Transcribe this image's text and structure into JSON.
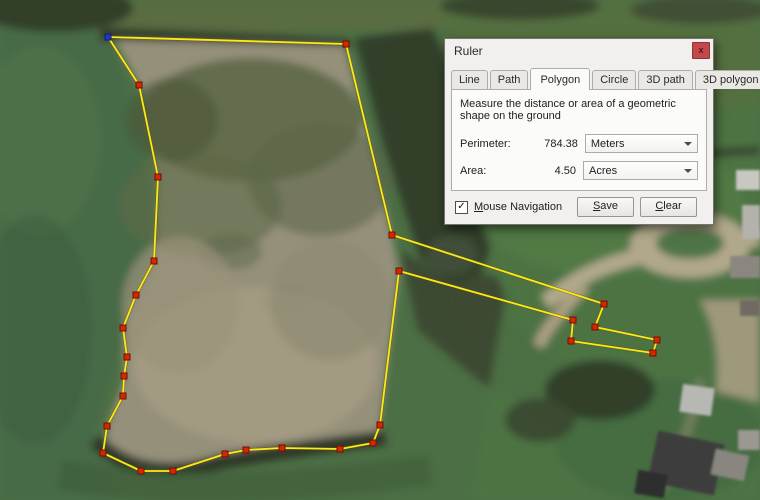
{
  "dialog": {
    "title": "Ruler",
    "close_label": "x",
    "tabs": [
      {
        "label": "Line"
      },
      {
        "label": "Path"
      },
      {
        "label": "Polygon",
        "active": true
      },
      {
        "label": "Circle"
      },
      {
        "label": "3D path"
      },
      {
        "label": "3D polygon"
      }
    ],
    "description": "Measure the distance or area of a geometric shape on the ground",
    "perimeter": {
      "label": "Perimeter:",
      "value": "784.38",
      "unit": "Meters"
    },
    "area": {
      "label": "Area:",
      "value": "4.50",
      "unit": "Acres"
    },
    "mouse_navigation": {
      "checked": true,
      "checkmark": "✓",
      "key": "M",
      "rest": "ouse Navigation"
    },
    "save_button": {
      "key": "S",
      "rest": "ave"
    },
    "clear_button": {
      "key": "C",
      "rest": "lear"
    }
  },
  "map": {
    "polygon": {
      "stroke_color": "#ffe81a",
      "vertex_color": "#d82700",
      "start_vertex_color": "#2433c8",
      "vertices": [
        [
          108,
          37
        ],
        [
          346,
          44
        ],
        [
          392,
          235
        ],
        [
          604,
          304
        ],
        [
          595,
          327
        ],
        [
          657,
          340
        ],
        [
          653,
          353
        ],
        [
          571,
          341
        ],
        [
          573,
          320
        ],
        [
          399,
          271
        ],
        [
          380,
          425
        ],
        [
          373,
          443
        ],
        [
          340,
          449
        ],
        [
          282,
          448
        ],
        [
          246,
          450
        ],
        [
          225,
          454
        ],
        [
          173,
          471
        ],
        [
          141,
          471
        ],
        [
          103,
          453
        ],
        [
          107,
          426
        ],
        [
          123,
          396
        ],
        [
          124,
          376
        ],
        [
          127,
          357
        ],
        [
          123,
          328
        ],
        [
          136,
          295
        ],
        [
          154,
          261
        ],
        [
          158,
          177
        ],
        [
          139,
          85
        ]
      ]
    }
  }
}
